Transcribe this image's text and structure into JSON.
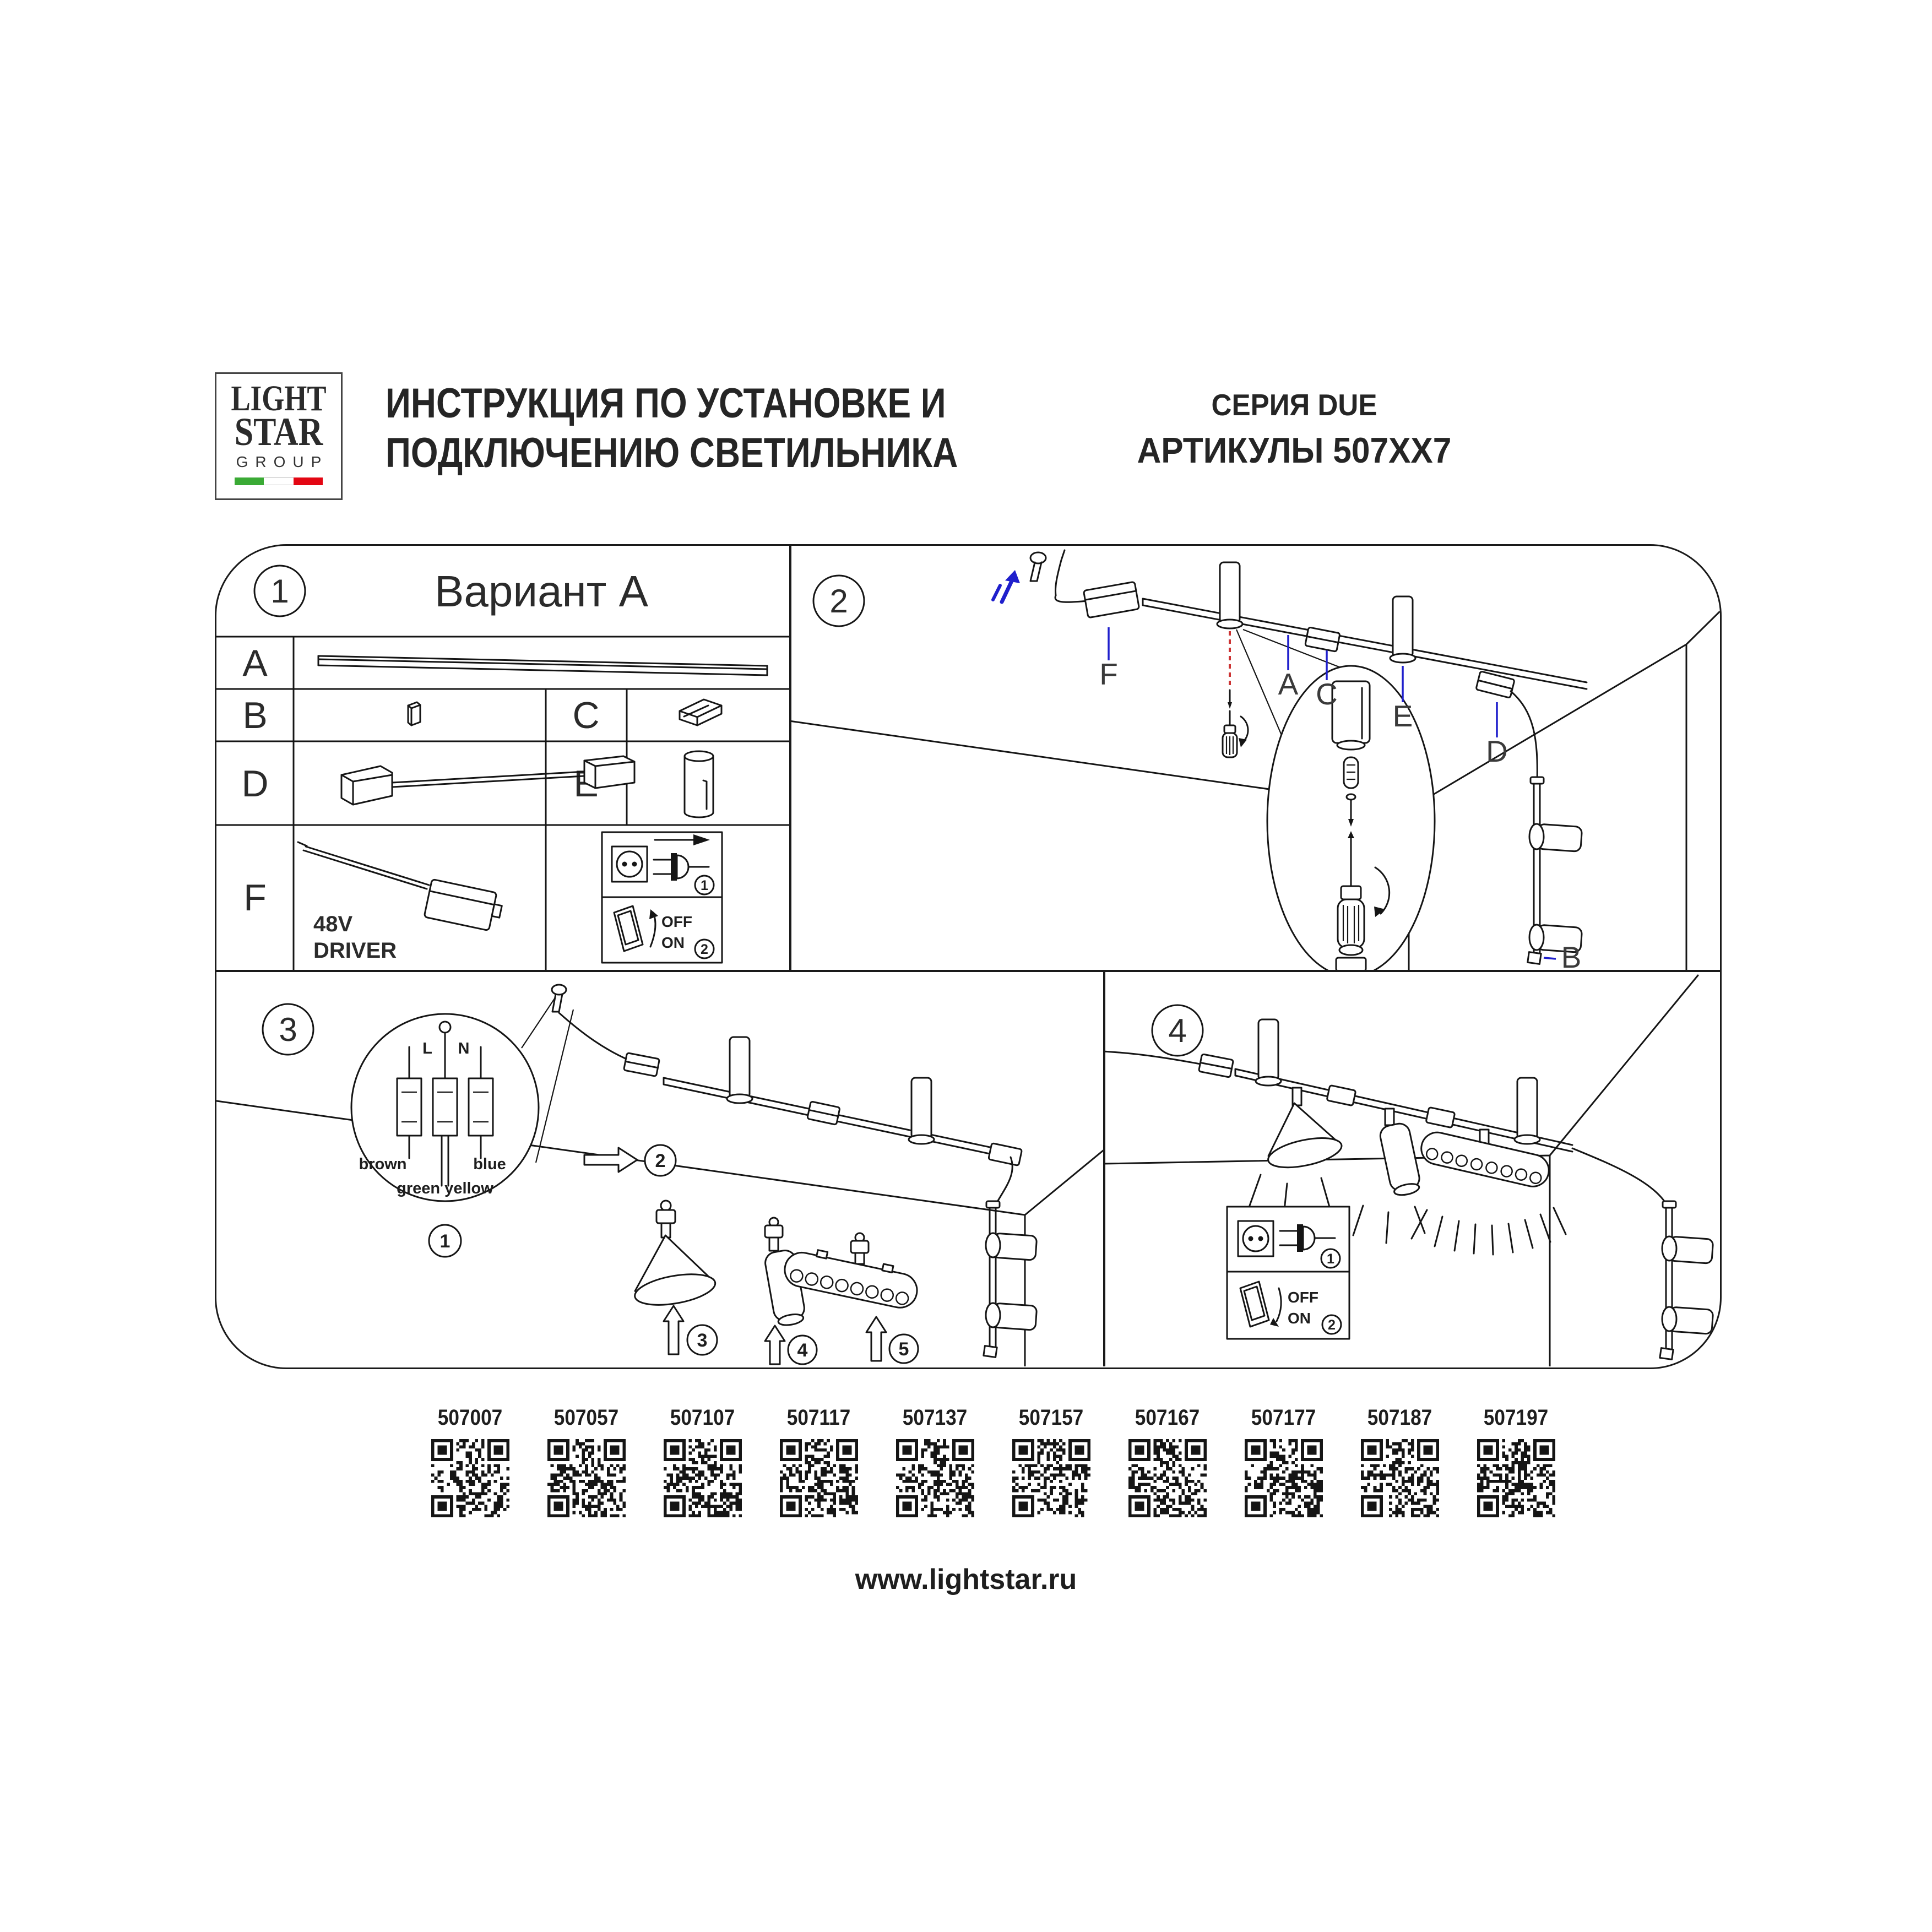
{
  "header": {
    "logo": {
      "word1": "LIGHT",
      "word2": "STAR",
      "word3": "GROUP"
    },
    "title_line1": "ИНСТРУКЦИЯ ПО УСТАНОВКЕ И",
    "title_line2": "ПОДКЛЮЧЕНИЮ СВЕТИЛЬНИКА",
    "series": "СЕРИЯ DUE",
    "articles": "АРТИКУЛЫ 507XX7"
  },
  "panel1": {
    "number": "1",
    "title": "Вариант A",
    "row_a": "A",
    "row_b": "B",
    "row_c": "C",
    "row_d": "D",
    "row_e": "E",
    "row_f": "F",
    "driver_line1": "48V",
    "driver_line2": "DRIVER",
    "power": {
      "step1": "1",
      "step2": "2",
      "off": "OFF",
      "on": "ON"
    }
  },
  "panel2": {
    "number": "2",
    "label_f": "F",
    "label_a": "A",
    "label_c": "C",
    "label_e": "E",
    "label_d": "D",
    "label_b": "B"
  },
  "panel3": {
    "number": "3",
    "wire_l": "L",
    "wire_n": "N",
    "wire_brown": "brown",
    "wire_blue": "blue",
    "wire_green_yellow": "green yellow",
    "step1": "1",
    "step2": "2",
    "step3": "3",
    "step4": "4",
    "step5": "5"
  },
  "panel4": {
    "number": "4",
    "power": {
      "step1": "1",
      "step2": "2",
      "off": "OFF",
      "on": "ON"
    }
  },
  "qr_codes": [
    {
      "article": "507007"
    },
    {
      "article": "507057"
    },
    {
      "article": "507107"
    },
    {
      "article": "507117"
    },
    {
      "article": "507137"
    },
    {
      "article": "507157"
    },
    {
      "article": "507167"
    },
    {
      "article": "507177"
    },
    {
      "article": "507187"
    },
    {
      "article": "507197"
    }
  ],
  "footer": {
    "website": "www.lightstar.ru"
  },
  "colors": {
    "ink": "#151515",
    "accent_blue": "#1f1fcc",
    "accent_red": "#cc3333",
    "flag_green": "#3aaa35",
    "flag_red": "#e30613"
  }
}
